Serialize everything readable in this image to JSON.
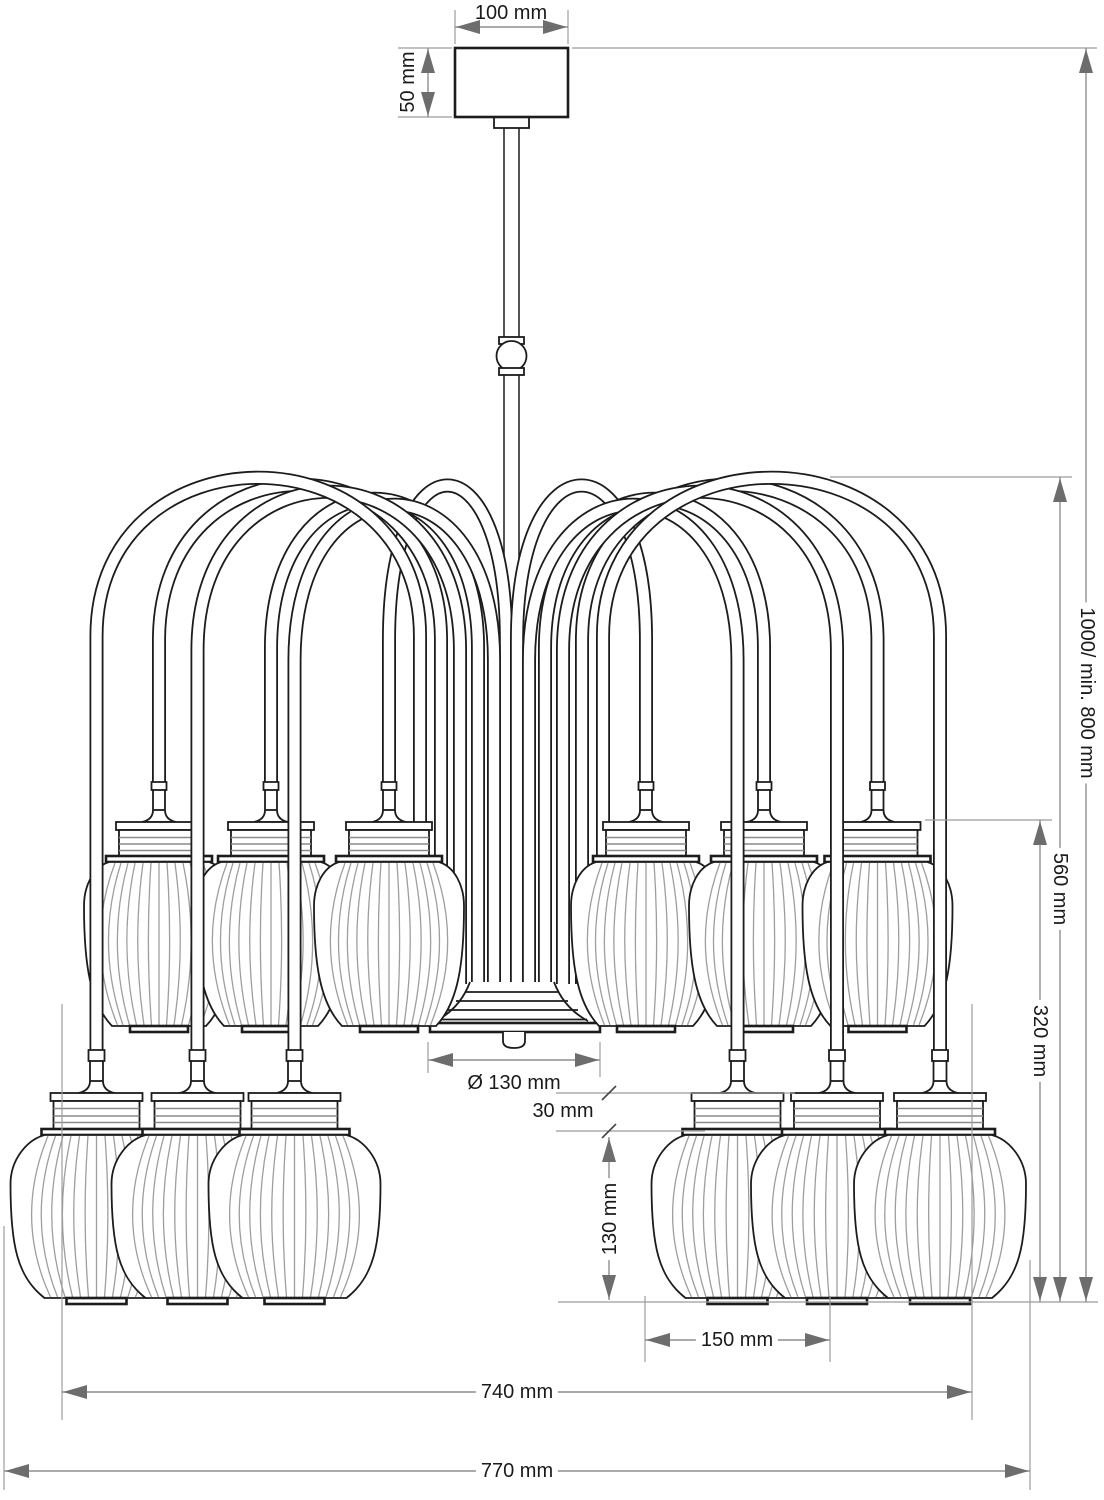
{
  "drawing": {
    "subject": "chandelier-dimension-drawing",
    "lantern_count": 12,
    "colors": {
      "outline": "#1c1c1c",
      "ghost_outline": "#b4b4b4",
      "rib": "#9e9e9e",
      "dimension_line": "#8e8e8e",
      "arrow": "#6d6d6d",
      "label_text": "#1a1a1a",
      "background": "#ffffff"
    }
  },
  "dims": {
    "canopy_width": "100 mm",
    "canopy_height": "50 mm",
    "overall_height": "1000/ min. 800 mm",
    "frame_height": "560 mm",
    "lower_tier_height": "320 mm",
    "hub_diameter": "Ø 130 mm",
    "holder_height": "30 mm",
    "shade_height": "130 mm",
    "shade_width": "150 mm",
    "inner_width": "740 mm",
    "overall_width": "770 mm"
  }
}
